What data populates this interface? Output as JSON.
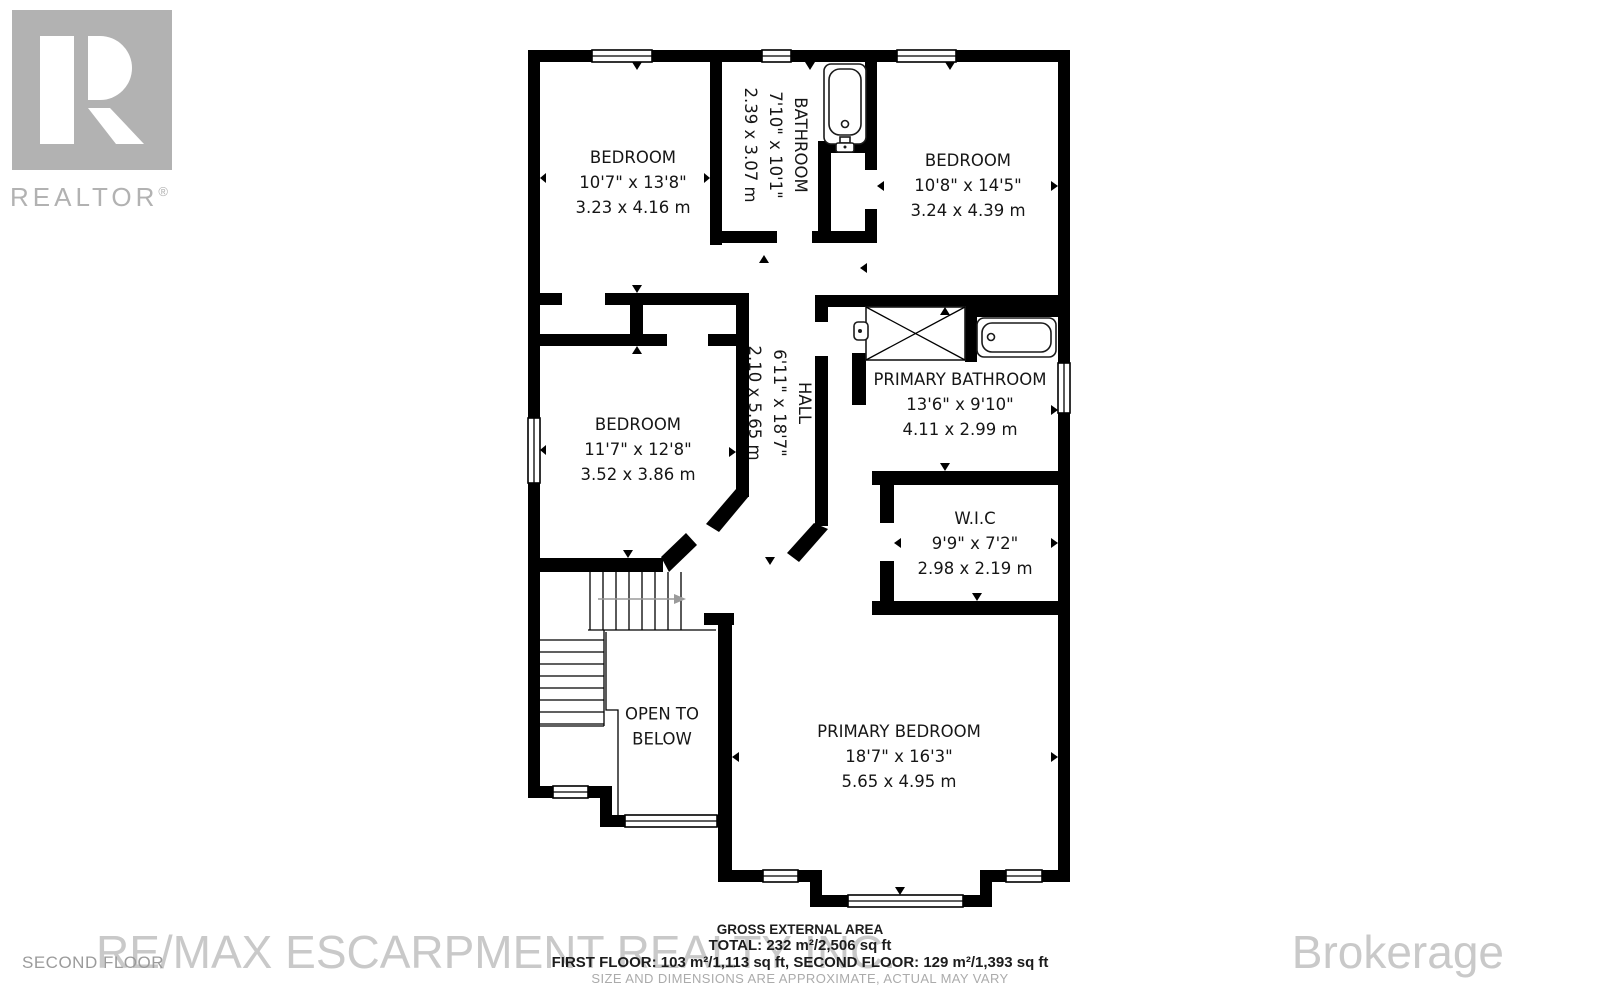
{
  "branding": {
    "logo_text": "REALTOR",
    "logo_reg": "®",
    "watermark_left": "RE/MAX ESCARPMENT REALTY INC.",
    "watermark_right": "Brokerage",
    "floor_label": "SECOND FLOOR"
  },
  "rooms": [
    {
      "name": "BEDROOM",
      "imperial": "10'7\" x 13'8\"",
      "metric": "3.23 x 4.16 m"
    },
    {
      "name": "BATHROOM",
      "imperial": "7'10\" x 10'1\"",
      "metric": "2.39 x 3.07 m"
    },
    {
      "name": "BEDROOM",
      "imperial": "10'8\" x 14'5\"",
      "metric": "3.24 x 4.39 m"
    },
    {
      "name": "BEDROOM",
      "imperial": "11'7\" x 12'8\"",
      "metric": "3.52 x 3.86 m"
    },
    {
      "name": "HALL",
      "imperial": "6'11\" x 18'7\"",
      "metric": "2.10 x 5.65 m"
    },
    {
      "name": "PRIMARY BATHROOM",
      "imperial": "13'6\" x 9'10\"",
      "metric": "4.11 x 2.99 m"
    },
    {
      "name": "W.I.C",
      "imperial": "9'9\" x 7'2\"",
      "metric": "2.98 x 2.19 m"
    },
    {
      "line1": "OPEN TO",
      "line2": "BELOW"
    },
    {
      "name": "PRIMARY BEDROOM",
      "imperial": "18'7\" x 16'3\"",
      "metric": "5.65 x 4.95 m"
    }
  ],
  "footer": {
    "title": "GROSS EXTERNAL AREA",
    "total": "TOTAL: 232 m²/2,506 sq ft",
    "floors": "FIRST FLOOR: 103 m²/1,113 sq ft, SECOND FLOOR: 129 m²/1,393 sq ft",
    "disclaimer": "SIZE AND DIMENSIONS ARE APPROXIMATE, ACTUAL MAY VARY"
  },
  "colors": {
    "wall": "#000000",
    "logo_gray": "#b2b2b2",
    "watermark_gray": "#c9c9c9",
    "muted_gray": "#9b9b9b"
  }
}
